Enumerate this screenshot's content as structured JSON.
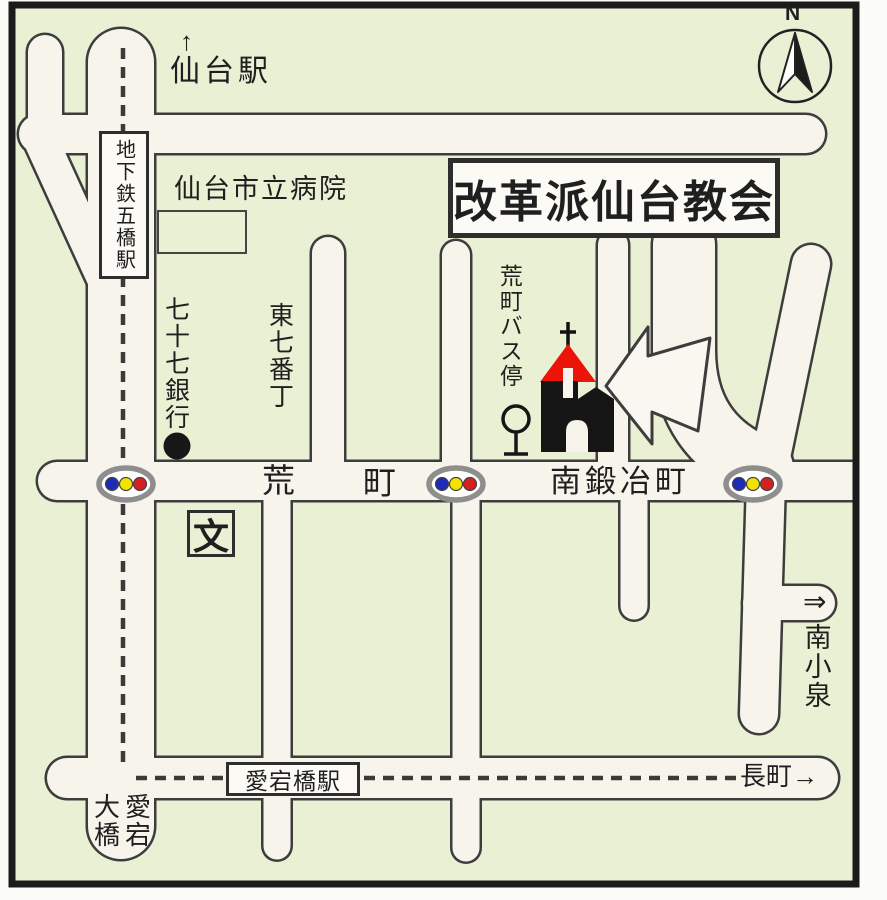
{
  "colors": {
    "background": "#e9f0d3",
    "road_fill": "#f7f4ec",
    "road_outline": "#3d3d3d",
    "church_red": "#ec1408",
    "signal_blue": "#1c2cb8",
    "signal_yellow": "#f2e300",
    "signal_red": "#d42020",
    "signal_ring": "#8e8e8e"
  },
  "title_box": {
    "label": "改革派仙台教会"
  },
  "compass": {
    "label": "N"
  },
  "landmarks": {
    "sendai_station": {
      "arrow": "↑",
      "label": "仙台駅"
    },
    "subway_station": {
      "label": "地下鉄五橋駅"
    },
    "city_hospital": {
      "label": "仙台市立病院"
    },
    "bank": {
      "label": "七十七銀行"
    },
    "school": {
      "label": "文"
    },
    "bus_stop": {
      "label": "荒町バス停"
    },
    "atagobashi_station": {
      "label": "愛宕橋駅"
    }
  },
  "streets": {
    "higashi_shichibancho": {
      "label": "東七番丁"
    },
    "aramachi_first": {
      "label": "荒"
    },
    "aramachi_second": {
      "label": "町"
    },
    "minami_kajimachi": {
      "label": "南鍛冶町"
    }
  },
  "directions": {
    "minami_koizumi": {
      "arrow": "⇒",
      "label": "南小泉"
    },
    "nagamachi": {
      "label": "長町→"
    },
    "atago_ohashi": {
      "right_column": "愛宕",
      "left_column": "大橋"
    }
  }
}
